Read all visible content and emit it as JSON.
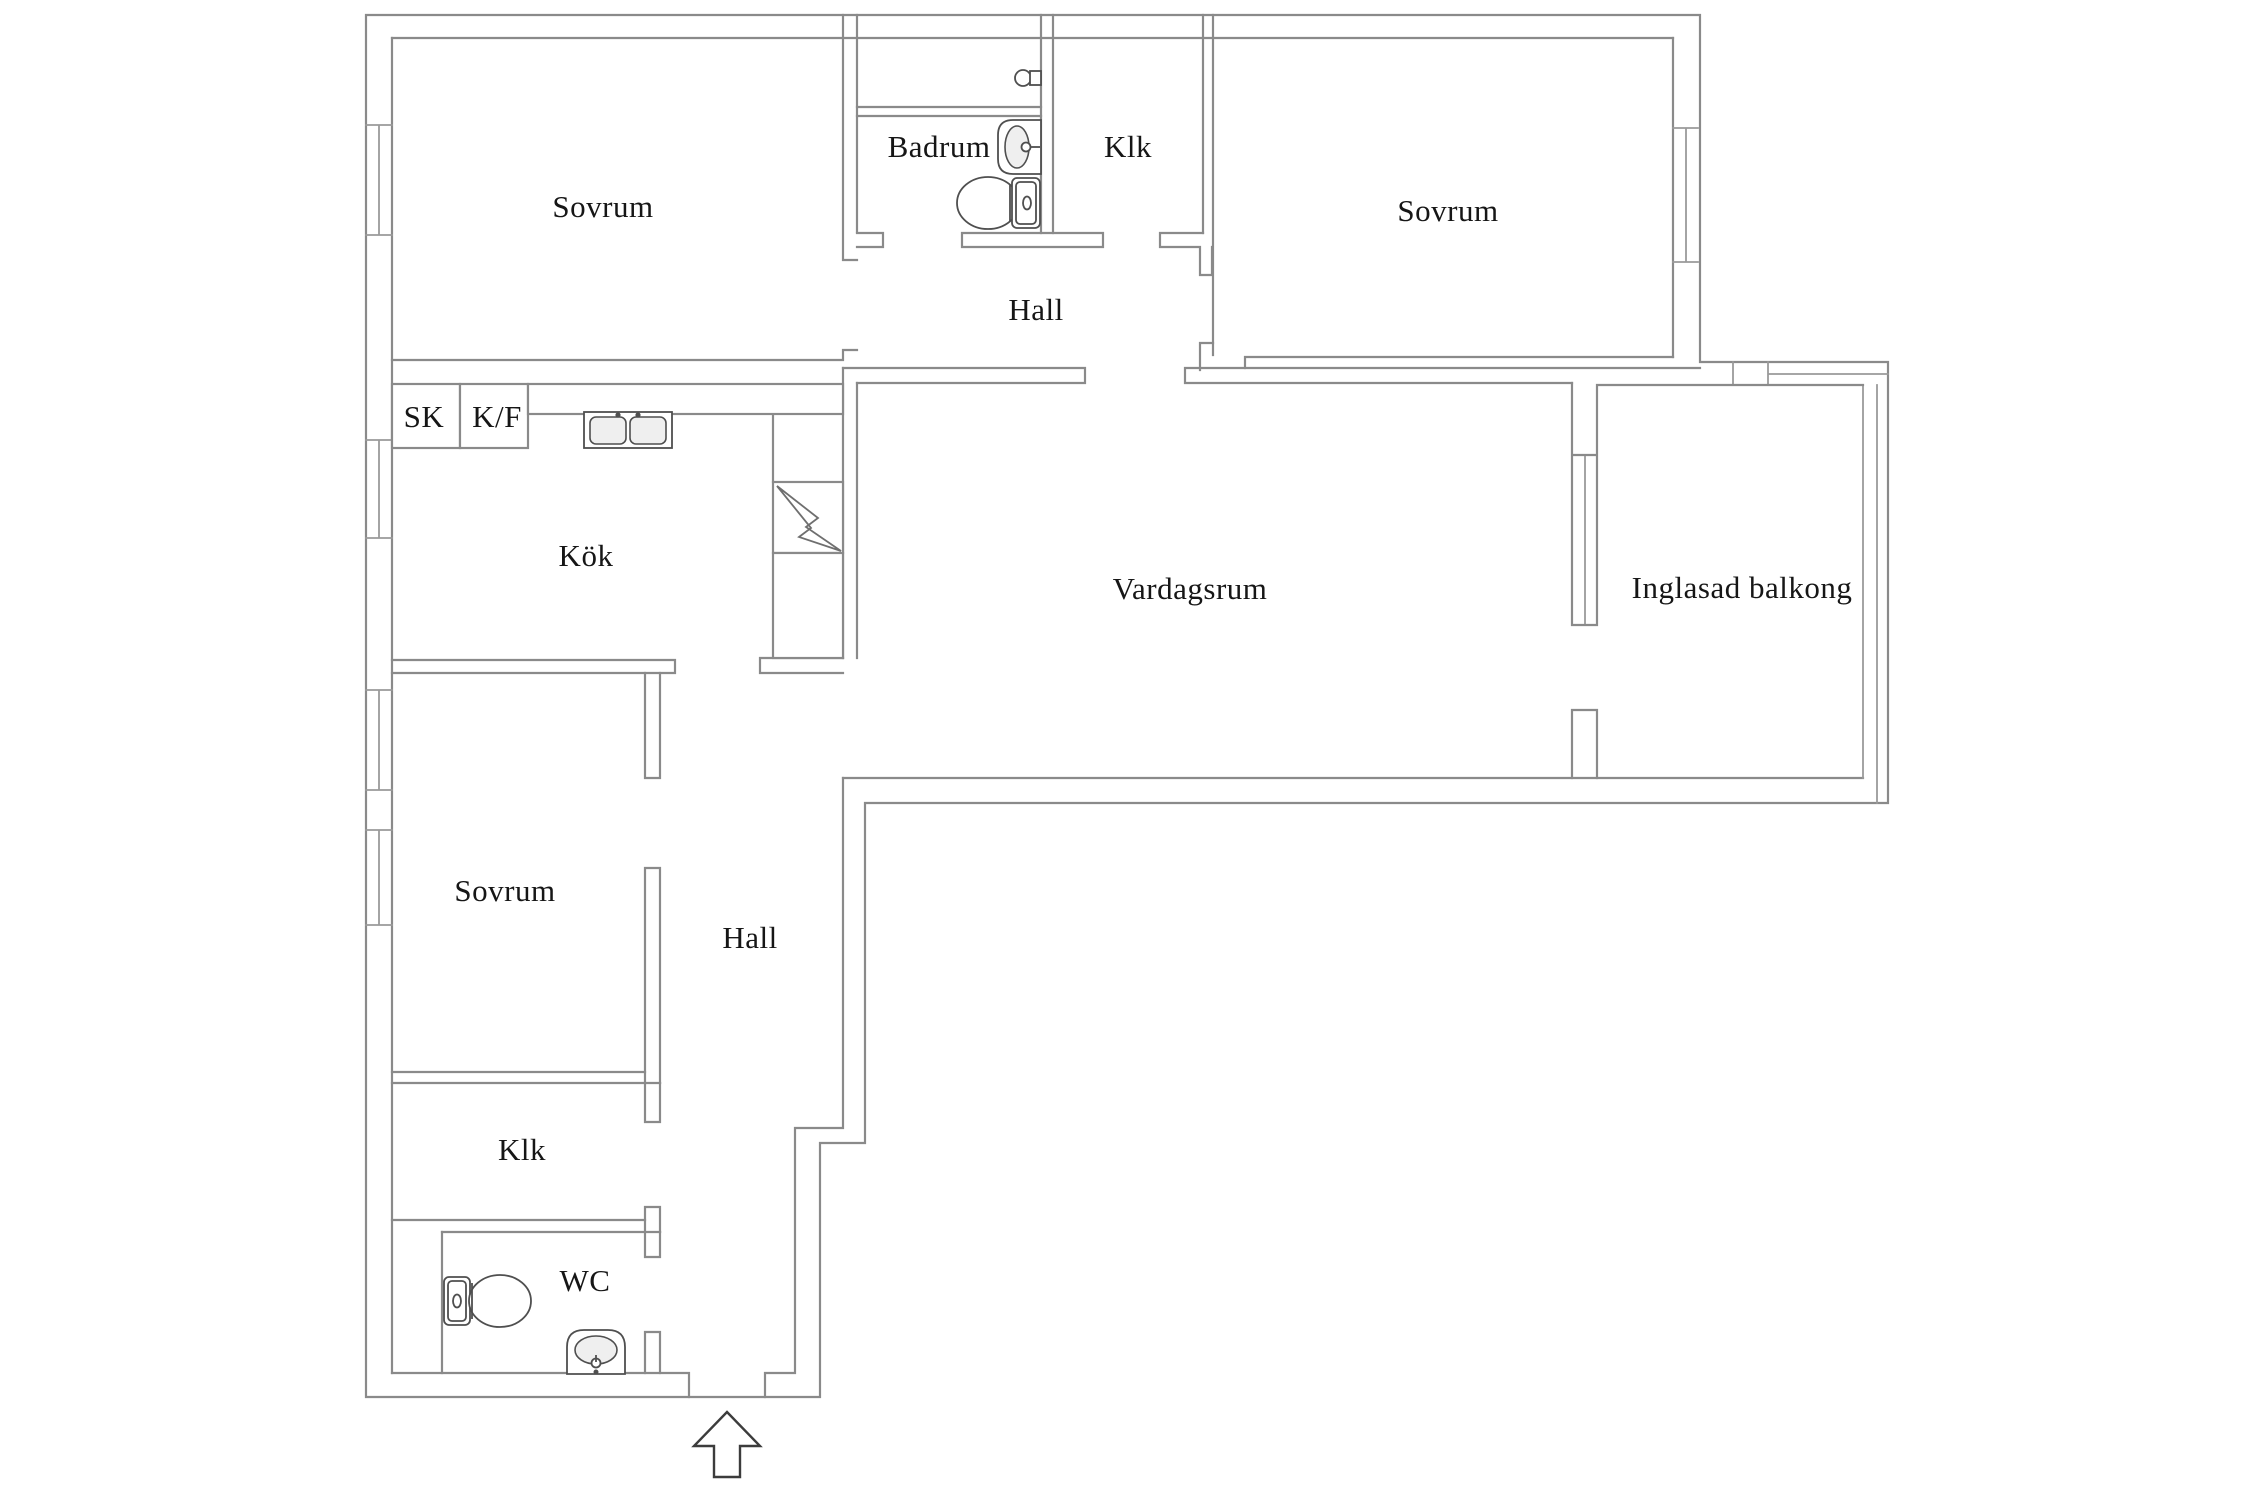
{
  "floorplan": {
    "labels": {
      "sovrum_tl": "Sovrum",
      "badrum": "Badrum",
      "klk_top": "Klk",
      "sovrum_tr": "Sovrum",
      "hall_top": "Hall",
      "sk": "SK",
      "kf": "K/F",
      "kok": "Kök",
      "vardagsrum": "Vardagsrum",
      "balkong": "Inglasad balkong",
      "sovrum_bl": "Sovrum",
      "hall_bottom": "Hall",
      "klk_bottom": "Klk",
      "wc": "WC"
    },
    "icons": {
      "entrance_arrow": "up-arrow entrance direction",
      "electrical_bolt": "lightning bolt in shaft square",
      "bathroom_sink": "wash basin",
      "bathroom_toilet": "toilet",
      "bathroom_tap": "wall tap",
      "kitchen_sink": "double-bowl kitchen sink",
      "wc_toilet": "toilet",
      "wc_sink": "wash basin",
      "window": "double-line window symbol"
    },
    "colors": {
      "background": "#ffffff",
      "wall_line": "#8a8a8a",
      "fixture_line": "#4f4f4f",
      "arrow_line": "#3c3c3c",
      "text": "#161616"
    }
  }
}
